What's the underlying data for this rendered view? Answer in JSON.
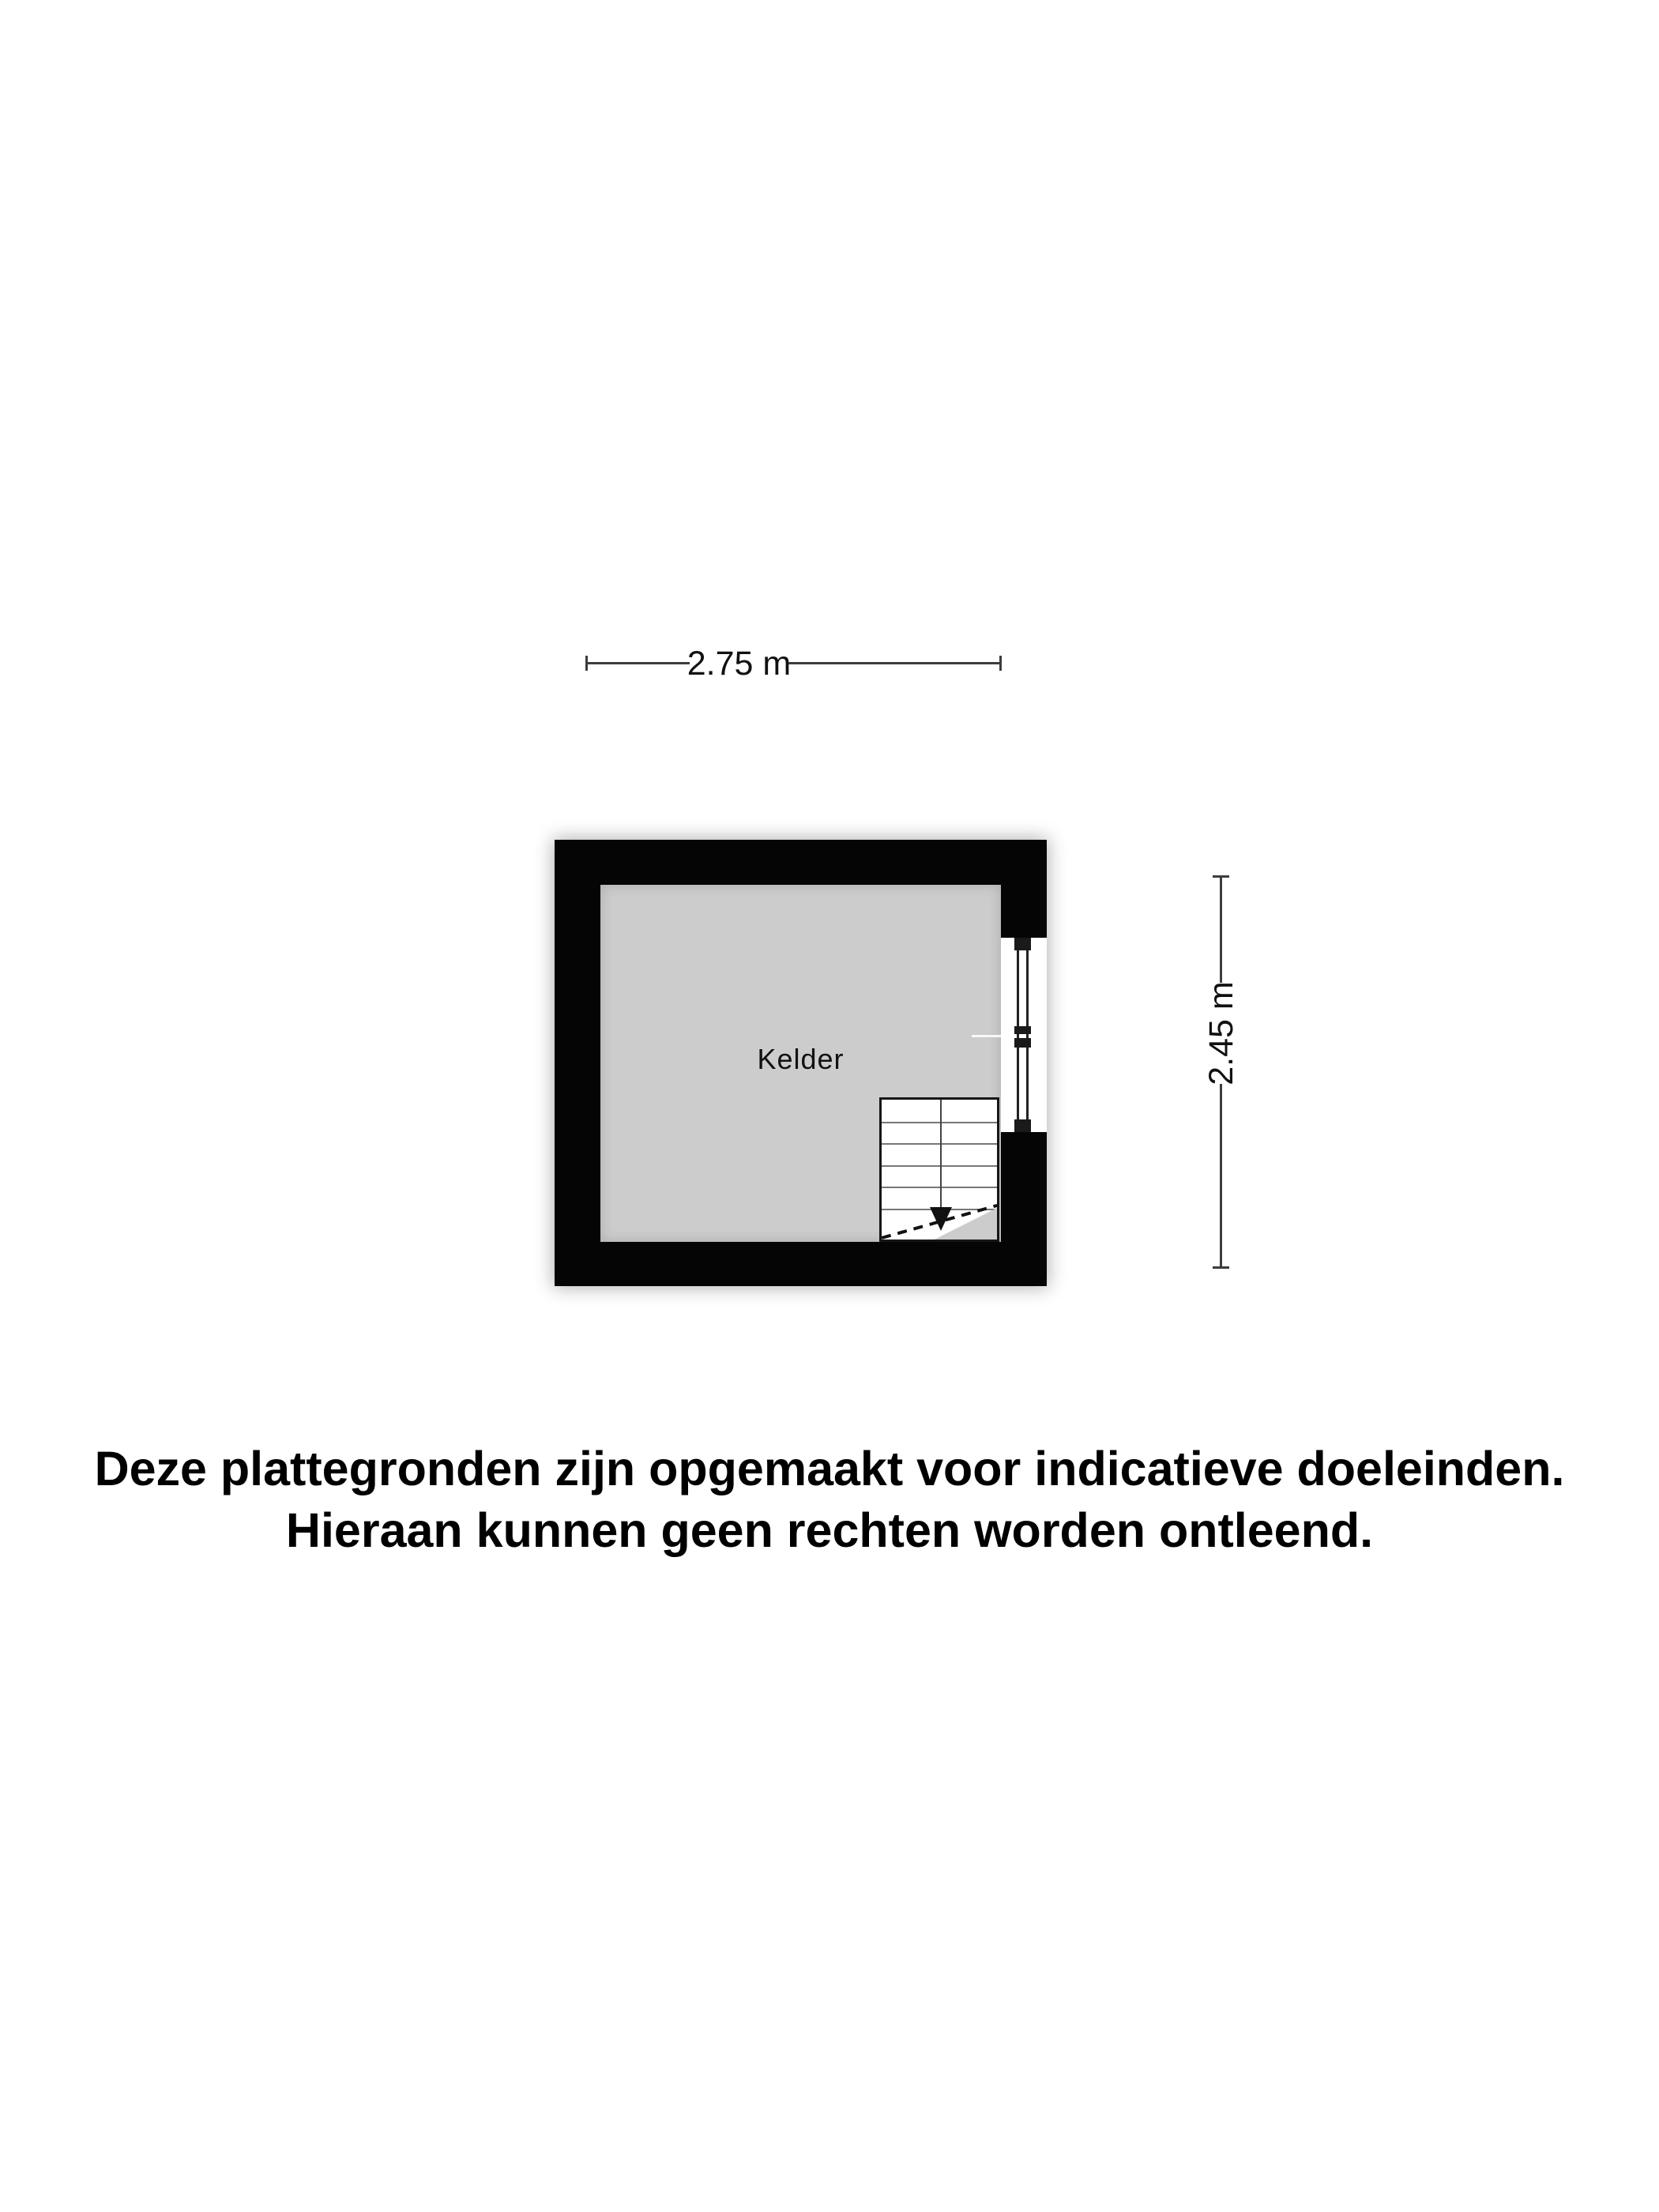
{
  "floorplan": {
    "room_label": "Kelder",
    "width_dimension": "2.75 m",
    "height_dimension": "2.45 m"
  },
  "disclaimer": {
    "line1": "Deze plattegronden zijn opgemaakt voor indicatieve doeleinden.",
    "line2": "Hieraan kunnen geen rechten worden ontleend."
  },
  "colors": {
    "background": "#ffffff",
    "wall": "#050505",
    "floor": "#cccccc",
    "dimension_line": "#3d3d3d",
    "text": "#111111"
  }
}
